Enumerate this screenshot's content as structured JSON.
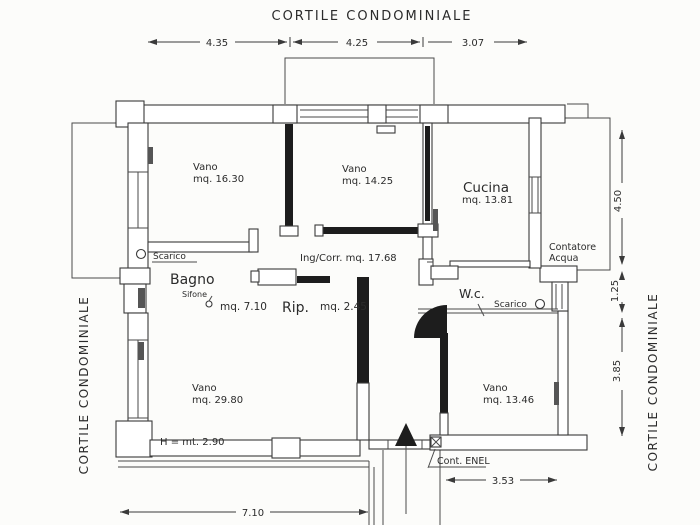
{
  "plan": {
    "title_top": "CORTILE  CONDOMINIALE",
    "courtyard_left": "CORTILE  CONDOMINIALE",
    "courtyard_right": "CORTILE  CONDOMINIALE",
    "dims": {
      "top_1": "4.35",
      "top_2": "4.25",
      "top_3": "3.07",
      "right_1": "4.50",
      "right_2": "1.25",
      "right_3": "3.85",
      "bottom_left": "7.10",
      "bottom_right": "3.53"
    },
    "rooms": {
      "vano1_name": "Vano",
      "vano1_area": "mq.  16.30",
      "vano2_name": "Vano",
      "vano2_area": "mq.  14.25",
      "cucina_name": "Cucina",
      "cucina_area": "mq.  13.81",
      "ingcorr": "Ing/Corr.  mq.  17.68",
      "bagno_name": "Bagno",
      "sifone": "Sifone",
      "bagno_area": "mq.  7.10",
      "rip_name": "Rip.",
      "rip_area": "mq.  2.45",
      "wc_name": "W.c.",
      "vano3_name": "Vano",
      "vano3_area": "mq.  29.80",
      "vano3_height": "H  =  mt.  2.90",
      "vano4_name": "Vano",
      "vano4_area": "mq.  13.46"
    },
    "annotations": {
      "scarico_bagno": "Scarico",
      "scarico_wc": "Scarico",
      "contatore_line1": "Contatore",
      "contatore_line2": "Acqua",
      "cont_enel": "Cont.  ENEL"
    }
  }
}
